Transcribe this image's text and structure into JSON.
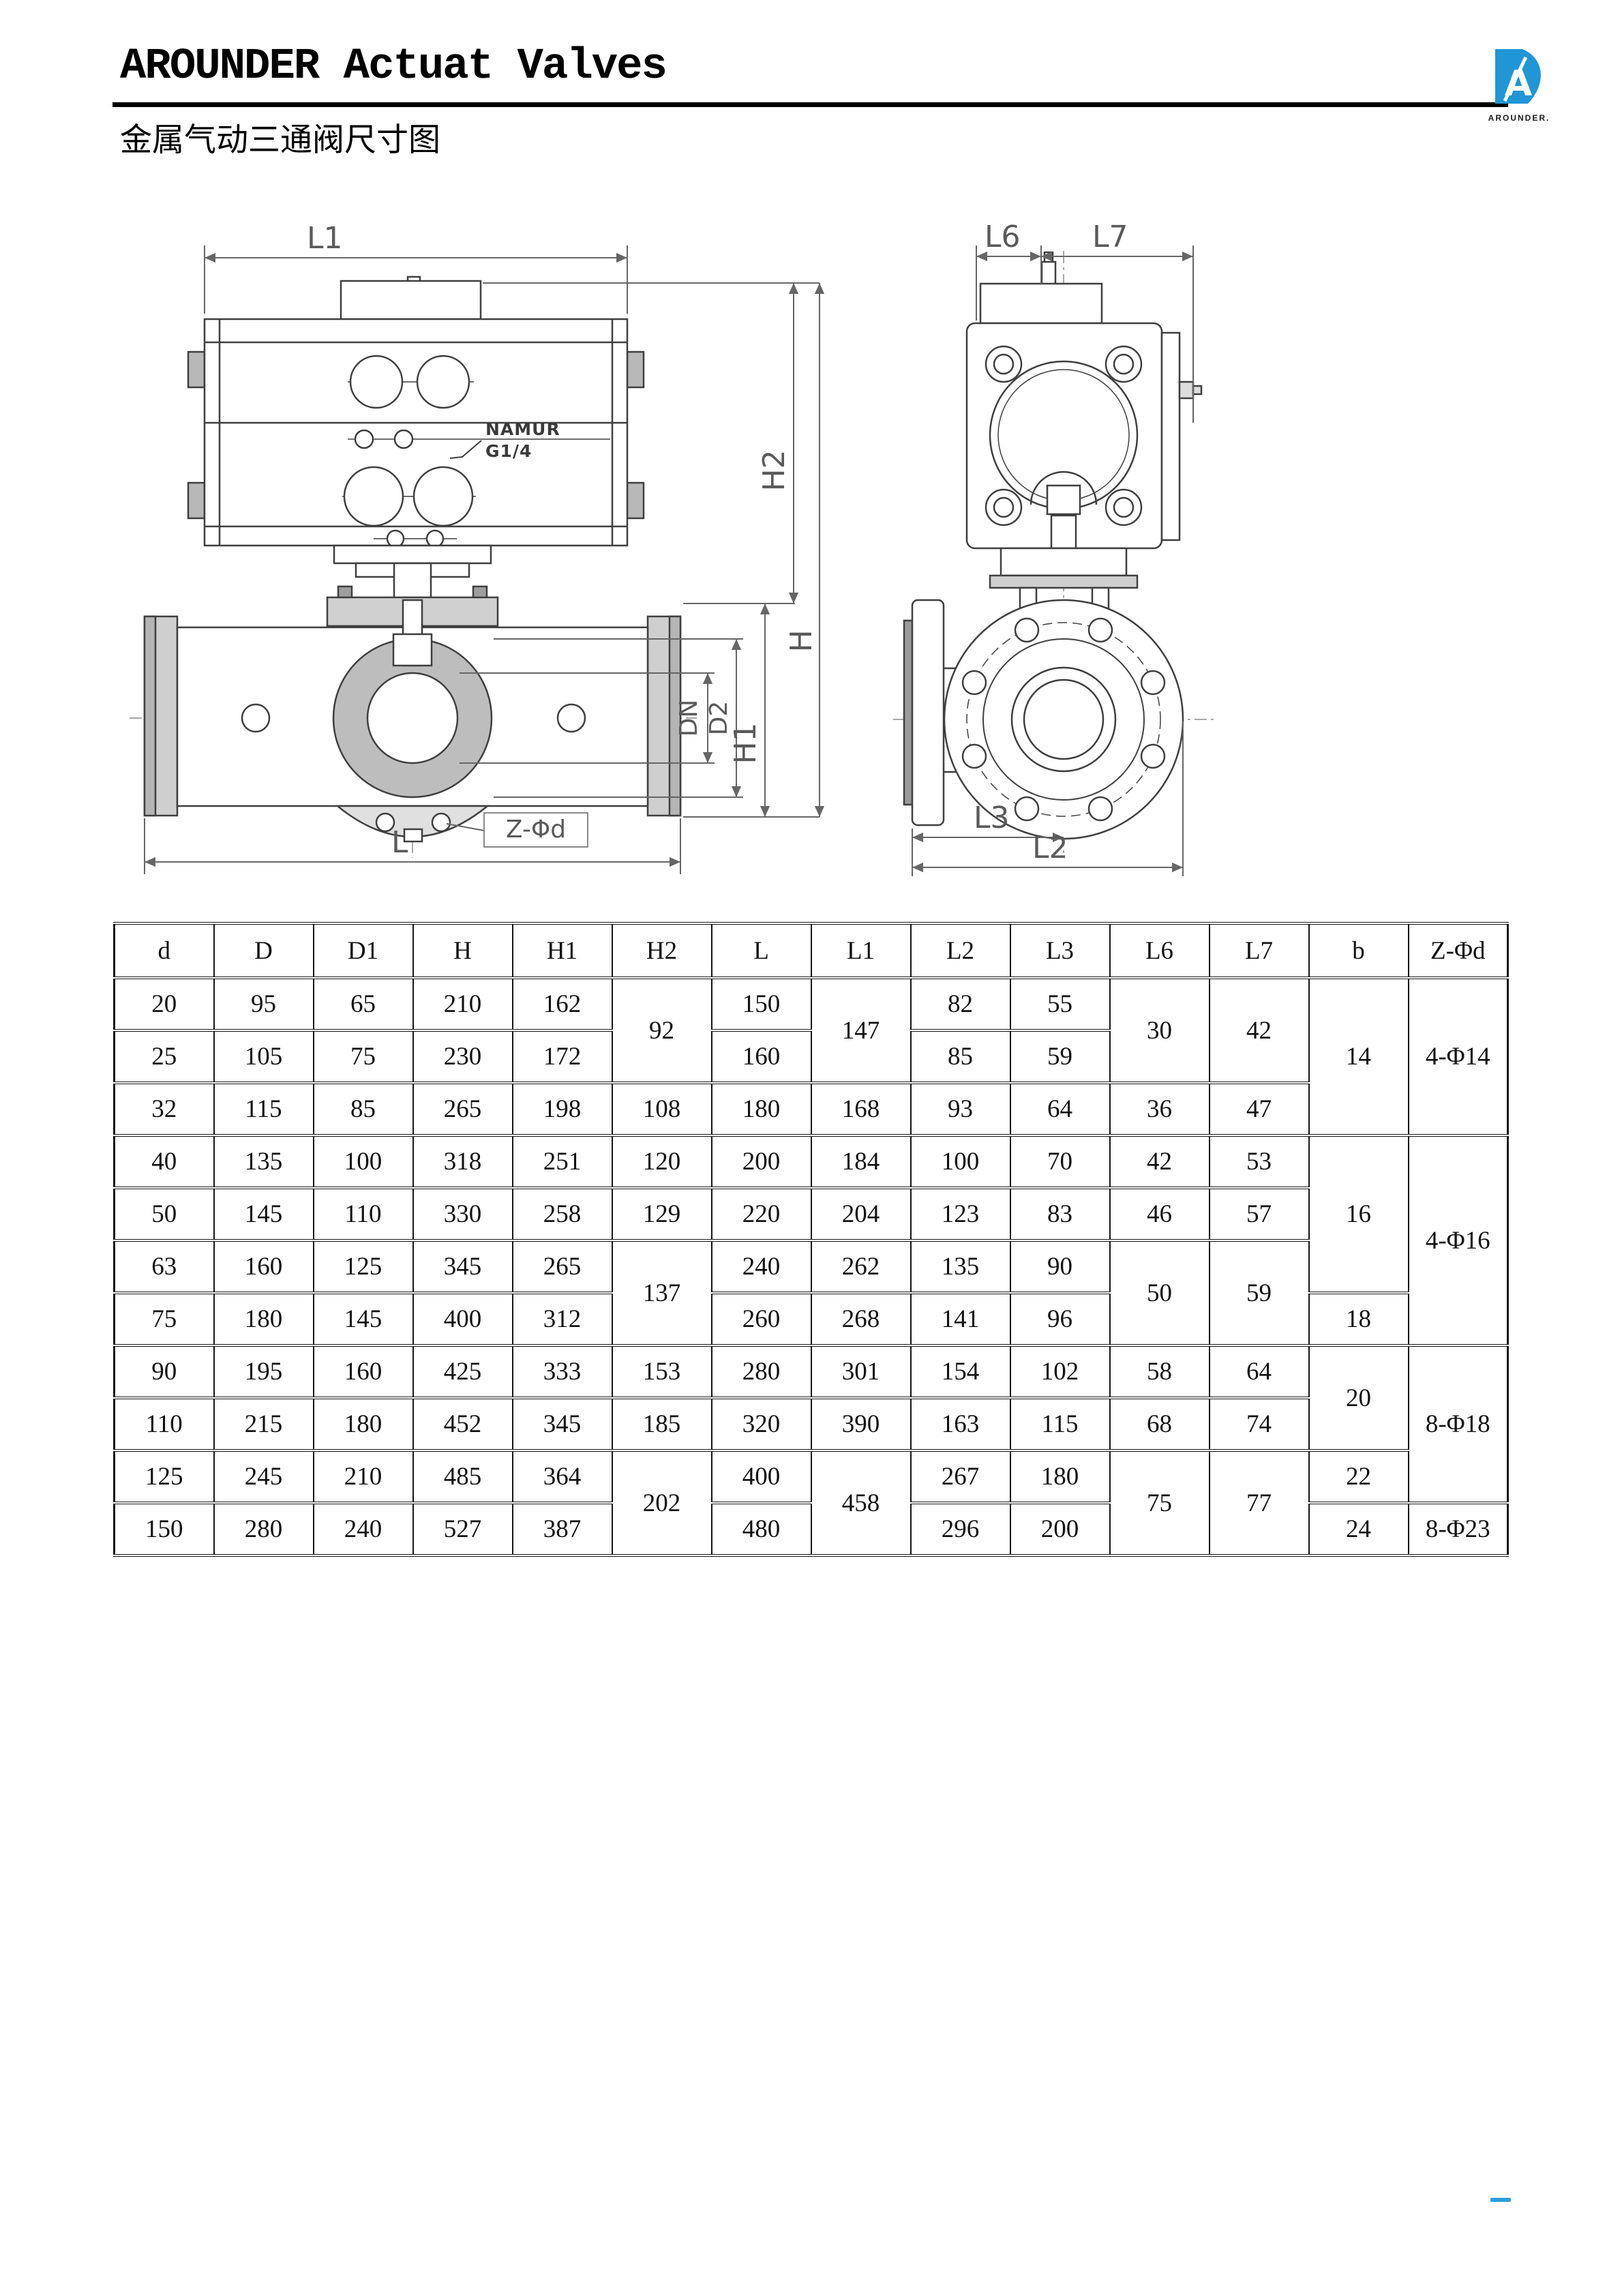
{
  "header": {
    "title": "AROUNDER Actuat Valves",
    "subtitle": "金属气动三通阀尺寸图"
  },
  "logo": {
    "monogram": "A",
    "brand": "AROUNDER.",
    "accent_color": "#2196d6"
  },
  "drawings": {
    "front_view": {
      "caption": "pneumatic actuator on three-way flanged ball valve, front section view",
      "annotation": {
        "line1": "NAMUR",
        "line2": "G1/4"
      },
      "dims": {
        "l1": "L1",
        "h2": "H2",
        "h": "H",
        "h1": "H1",
        "dn": "DN",
        "d2": "D2",
        "z_phi_d": "Z-Φd",
        "l": "L"
      }
    },
    "side_view": {
      "caption": "valve side view with flange bolt circle",
      "dims": {
        "l6": "L6",
        "l7": "L7",
        "l3": "L3",
        "l2": "L2"
      }
    }
  },
  "table": {
    "headers": [
      "d",
      "D",
      "D1",
      "H",
      "H1",
      "H2",
      "L",
      "L1",
      "L2",
      "L3",
      "L6",
      "L7",
      "b",
      "Z-Φd"
    ],
    "rows": [
      [
        "20",
        "95",
        "65",
        "210",
        "162",
        {
          "v": "92",
          "rs": 2
        },
        "150",
        {
          "v": "147",
          "rs": 2
        },
        "82",
        "55",
        {
          "v": "30",
          "rs": 2
        },
        {
          "v": "42",
          "rs": 2
        },
        {
          "v": "14",
          "rs": 3
        },
        {
          "v": "4-Φ14",
          "rs": 3
        }
      ],
      [
        "25",
        "105",
        "75",
        "230",
        "172",
        "160",
        "85",
        "59"
      ],
      [
        "32",
        "115",
        "85",
        "265",
        "198",
        "108",
        "180",
        "168",
        "93",
        "64",
        "36",
        "47"
      ],
      [
        "40",
        "135",
        "100",
        "318",
        "251",
        "120",
        "200",
        "184",
        "100",
        "70",
        "42",
        "53",
        {
          "v": "16",
          "rs": 3
        },
        {
          "v": "4-Φ16",
          "rs": 4
        }
      ],
      [
        "50",
        "145",
        "110",
        "330",
        "258",
        "129",
        "220",
        "204",
        "123",
        "83",
        "46",
        "57"
      ],
      [
        "63",
        "160",
        "125",
        "345",
        "265",
        {
          "v": "137",
          "rs": 2
        },
        "240",
        "262",
        "135",
        "90",
        {
          "v": "50",
          "rs": 2
        },
        {
          "v": "59",
          "rs": 2
        }
      ],
      [
        "75",
        "180",
        "145",
        "400",
        "312",
        "260",
        "268",
        "141",
        "96",
        "18"
      ],
      [
        "90",
        "195",
        "160",
        "425",
        "333",
        "153",
        "280",
        "301",
        "154",
        "102",
        "58",
        "64",
        {
          "v": "20",
          "rs": 2
        },
        {
          "v": "8-Φ18",
          "rs": 3
        }
      ],
      [
        "110",
        "215",
        "180",
        "452",
        "345",
        "185",
        "320",
        "390",
        "163",
        "115",
        "68",
        "74"
      ],
      [
        "125",
        "245",
        "210",
        "485",
        "364",
        {
          "v": "202",
          "rs": 2
        },
        "400",
        {
          "v": "458",
          "rs": 2
        },
        "267",
        "180",
        {
          "v": "75",
          "rs": 2
        },
        {
          "v": "77",
          "rs": 2
        },
        "22"
      ],
      [
        "150",
        "280",
        "240",
        "527",
        "387",
        "480",
        "296",
        "200",
        "24",
        "8-Φ23"
      ]
    ]
  },
  "footer": {
    "corner_mark_color": "#2b9fe0"
  }
}
